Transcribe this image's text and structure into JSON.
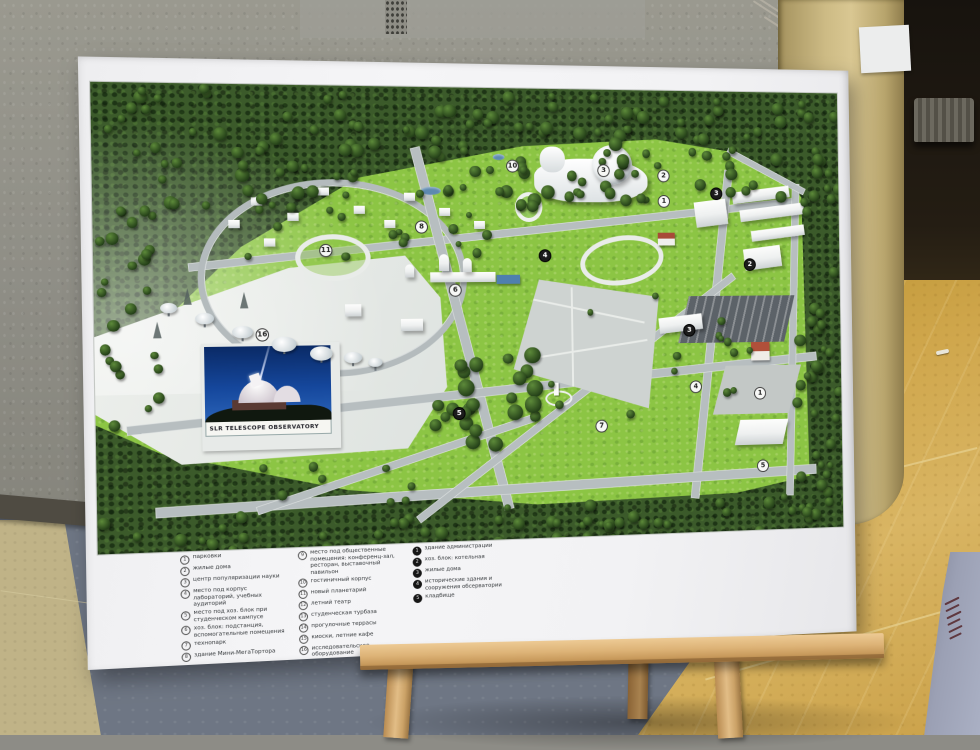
{
  "scene": {
    "description": "photo of an observatory campus master-plan poster standing on a wooden easel indoors",
    "colors": {
      "campus_green": "#8cc544",
      "forest_green": "#3b5a2a",
      "road_gray": "#b7bec0",
      "poster_white": "#f2f2f4",
      "floor_yellow": "#cfa64b",
      "easel_wood": "#ddb377"
    }
  },
  "poster": {
    "inset": {
      "caption": "SLR TELESCOPE OBSERVATORY"
    },
    "map": {
      "markers": [
        {
          "n": "10",
          "x": 410,
          "y": 78,
          "style": "light"
        },
        {
          "n": "3",
          "x": 504,
          "y": 82,
          "style": "light"
        },
        {
          "n": "2",
          "x": 567,
          "y": 87,
          "style": "light"
        },
        {
          "n": "3",
          "x": 623,
          "y": 105,
          "style": "dark"
        },
        {
          "n": "1",
          "x": 567,
          "y": 113,
          "style": "light"
        },
        {
          "n": "2",
          "x": 658,
          "y": 178,
          "style": "dark"
        },
        {
          "n": "4",
          "x": 442,
          "y": 168,
          "style": "dark"
        },
        {
          "n": "6",
          "x": 350,
          "y": 202,
          "style": "light"
        },
        {
          "n": "5",
          "x": 352,
          "y": 325,
          "style": "dark"
        },
        {
          "n": "3",
          "x": 592,
          "y": 245,
          "style": "dark"
        },
        {
          "n": "1",
          "x": 667,
          "y": 311,
          "style": "light"
        },
        {
          "n": "4",
          "x": 598,
          "y": 303,
          "style": "light"
        },
        {
          "n": "5",
          "x": 669,
          "y": 386,
          "style": "light"
        },
        {
          "n": "7",
          "x": 498,
          "y": 341,
          "style": "light"
        },
        {
          "n": "16",
          "x": 159,
          "y": 244,
          "style": "light"
        },
        {
          "n": "11",
          "x": 222,
          "y": 162,
          "style": "light"
        },
        {
          "n": "8",
          "x": 317,
          "y": 139,
          "style": "light"
        }
      ]
    },
    "legend": {
      "columns": [
        {
          "style": "outline",
          "items": [
            {
              "n": "1",
              "label": "парковки"
            },
            {
              "n": "2",
              "label": "жилые дома"
            },
            {
              "n": "3",
              "label": "центр популяризации науки"
            },
            {
              "n": "4",
              "label": "место под корпус лабораторий, учебных аудиторий"
            },
            {
              "n": "5",
              "label": "место под хоз. блок при студенческом кампусе"
            },
            {
              "n": "6",
              "label": "хоз. блок: подстанция, вспомогательные помещения"
            },
            {
              "n": "7",
              "label": "технопарк"
            },
            {
              "n": "8",
              "label": "здание Мини-МегаТортора"
            }
          ]
        },
        {
          "style": "outline",
          "items": [
            {
              "n": "9",
              "label": "место под общественные помещения: конференц-зал, ресторан, выставочный павильон"
            },
            {
              "n": "10",
              "label": "гостиничный корпус"
            },
            {
              "n": "11",
              "label": "новый планетарий"
            },
            {
              "n": "12",
              "label": "летний театр"
            },
            {
              "n": "13",
              "label": "студенческая турбаза"
            },
            {
              "n": "14",
              "label": "прогулочные террасы"
            },
            {
              "n": "15",
              "label": "киоски, летние кафе"
            },
            {
              "n": "16",
              "label": "исследовательское оборудование"
            }
          ]
        },
        {
          "style": "filled",
          "items": [
            {
              "n": "1",
              "label": "здание администрации"
            },
            {
              "n": "2",
              "label": "хоз. блок: котельная"
            },
            {
              "n": "3",
              "label": "жилые дома"
            },
            {
              "n": "4",
              "label": "исторические здания и сооружения обсерватории"
            },
            {
              "n": "5",
              "label": "кладбище"
            }
          ]
        }
      ]
    }
  }
}
